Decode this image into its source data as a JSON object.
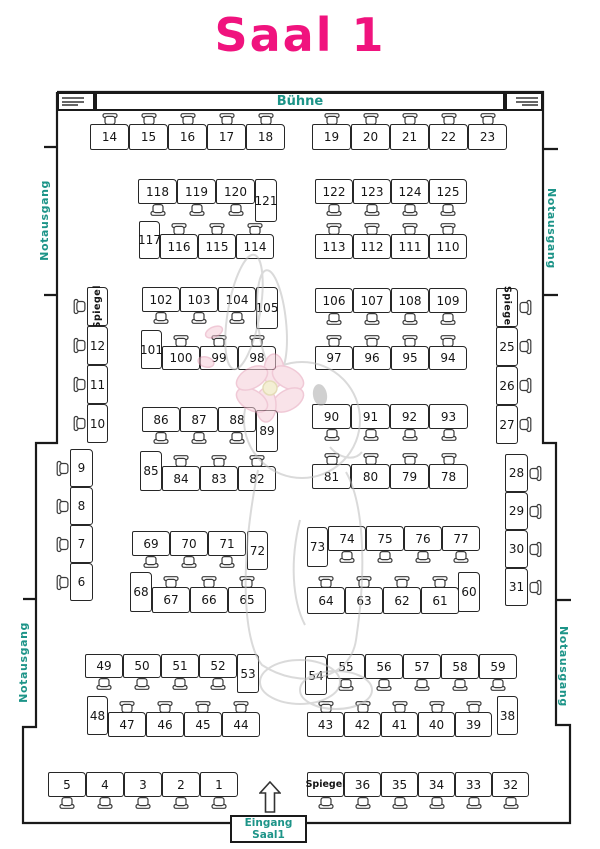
{
  "title": "Saal 1",
  "labels": {
    "stage": "Bühne",
    "exit": "Notausgang",
    "mirror": "Spiegel",
    "entrance_line1": "Eingang",
    "entrance_line2": "Saal1"
  },
  "colors": {
    "pink": "#f0137e",
    "teal": "#1d9488",
    "line": "#1a1a1a"
  },
  "groups": [
    {
      "type": "hrow",
      "x": 90,
      "y": 124,
      "w": 39,
      "h": 26,
      "chair": "top",
      "tables": [
        "14",
        "15",
        "16",
        "17",
        "18"
      ]
    },
    {
      "type": "hrow",
      "x": 312,
      "y": 124,
      "w": 39,
      "h": 26,
      "chair": "top",
      "tables": [
        "19",
        "20",
        "21",
        "22",
        "23"
      ]
    },
    {
      "type": "hrow",
      "x": 138,
      "y": 179,
      "w": 39,
      "h": 25,
      "chair": "bottom",
      "tables": [
        "118",
        "119",
        "120"
      ]
    },
    {
      "type": "vtable",
      "x": 255,
      "y": 179,
      "w": 22,
      "h": 43,
      "label": "121"
    },
    {
      "type": "hrow",
      "x": 315,
      "y": 179,
      "w": 38,
      "h": 25,
      "chair": "bottom",
      "tables": [
        "122",
        "123",
        "124",
        "125"
      ]
    },
    {
      "type": "vtable",
      "x": 139,
      "y": 221,
      "w": 21,
      "h": 38,
      "label": "117"
    },
    {
      "type": "hrow",
      "x": 160,
      "y": 234,
      "w": 38,
      "h": 25,
      "chair": "top",
      "tables": [
        "116",
        "115",
        "114"
      ]
    },
    {
      "type": "hrow",
      "x": 315,
      "y": 234,
      "w": 38,
      "h": 25,
      "chair": "top",
      "tables": [
        "113",
        "112",
        "111",
        "110"
      ]
    },
    {
      "type": "hrow",
      "x": 142,
      "y": 287,
      "w": 38,
      "h": 25,
      "chair": "bottom",
      "tables": [
        "102",
        "103",
        "104"
      ]
    },
    {
      "type": "vtable",
      "x": 256,
      "y": 287,
      "w": 22,
      "h": 42,
      "label": "105"
    },
    {
      "type": "hrow",
      "x": 315,
      "y": 288,
      "w": 38,
      "h": 25,
      "chair": "bottom",
      "tables": [
        "106",
        "107",
        "108",
        "109"
      ]
    },
    {
      "type": "vtable",
      "x": 141,
      "y": 330,
      "w": 21,
      "h": 39,
      "label": "101"
    },
    {
      "type": "hrow",
      "x": 162,
      "y": 346,
      "w": 38,
      "h": 24,
      "chair": "top",
      "tables": [
        "100",
        "99",
        "98"
      ]
    },
    {
      "type": "hrow",
      "x": 315,
      "y": 346,
      "w": 38,
      "h": 24,
      "chair": "top",
      "tables": [
        "97",
        "96",
        "95",
        "94"
      ]
    },
    {
      "type": "hrow",
      "x": 142,
      "y": 407,
      "w": 38,
      "h": 25,
      "chair": "bottom",
      "tables": [
        "86",
        "87",
        "88"
      ]
    },
    {
      "type": "vtable",
      "x": 256,
      "y": 410,
      "w": 22,
      "h": 42,
      "label": "89"
    },
    {
      "type": "hrow",
      "x": 312,
      "y": 404,
      "w": 39,
      "h": 25,
      "chair": "bottom",
      "tables": [
        "90",
        "91",
        "92",
        "93"
      ]
    },
    {
      "type": "vtable",
      "x": 140,
      "y": 451,
      "w": 22,
      "h": 40,
      "label": "85"
    },
    {
      "type": "hrow",
      "x": 162,
      "y": 466,
      "w": 38,
      "h": 25,
      "chair": "top",
      "tables": [
        "84",
        "83",
        "82"
      ]
    },
    {
      "type": "hrow",
      "x": 312,
      "y": 464,
      "w": 39,
      "h": 25,
      "chair": "top",
      "tables": [
        "81",
        "80",
        "79",
        "78"
      ]
    },
    {
      "type": "hrow",
      "x": 132,
      "y": 531,
      "w": 38,
      "h": 25,
      "chair": "bottom",
      "tables": [
        "69",
        "70",
        "71"
      ]
    },
    {
      "type": "vtable",
      "x": 247,
      "y": 531,
      "w": 21,
      "h": 39,
      "label": "72"
    },
    {
      "type": "vtable",
      "x": 307,
      "y": 527,
      "w": 21,
      "h": 40,
      "label": "73"
    },
    {
      "type": "hrow",
      "x": 328,
      "y": 526,
      "w": 38,
      "h": 25,
      "chair": "bottom",
      "tables": [
        "74",
        "75",
        "76",
        "77"
      ]
    },
    {
      "type": "vtable",
      "x": 130,
      "y": 572,
      "w": 22,
      "h": 40,
      "label": "68"
    },
    {
      "type": "hrow",
      "x": 152,
      "y": 587,
      "w": 38,
      "h": 26,
      "chair": "top",
      "tables": [
        "67",
        "66",
        "65"
      ]
    },
    {
      "type": "hrow",
      "x": 307,
      "y": 587,
      "w": 38,
      "h": 27,
      "chair": "top",
      "tables": [
        "64",
        "63",
        "62",
        "61"
      ]
    },
    {
      "type": "vtable",
      "x": 458,
      "y": 572,
      "w": 22,
      "h": 40,
      "label": "60"
    },
    {
      "type": "hrow",
      "x": 85,
      "y": 654,
      "w": 38,
      "h": 24,
      "chair": "bottom",
      "tables": [
        "49",
        "50",
        "51",
        "52"
      ]
    },
    {
      "type": "vtable",
      "x": 237,
      "y": 654,
      "w": 22,
      "h": 39,
      "label": "53"
    },
    {
      "type": "vtable",
      "x": 305,
      "y": 656,
      "w": 22,
      "h": 39,
      "label": "54"
    },
    {
      "type": "hrow",
      "x": 327,
      "y": 654,
      "w": 38,
      "h": 25,
      "chair": "bottom",
      "tables": [
        "55",
        "56",
        "57",
        "58",
        "59"
      ]
    },
    {
      "type": "vtable",
      "x": 87,
      "y": 696,
      "w": 21,
      "h": 39,
      "label": "48"
    },
    {
      "type": "hrow",
      "x": 108,
      "y": 712,
      "w": 38,
      "h": 25,
      "chair": "top",
      "tables": [
        "47",
        "46",
        "45",
        "44"
      ]
    },
    {
      "type": "hrow",
      "x": 307,
      "y": 712,
      "w": 37,
      "h": 25,
      "chair": "top",
      "tables": [
        "43",
        "42",
        "41",
        "40",
        "39"
      ]
    },
    {
      "type": "vtable",
      "x": 497,
      "y": 696,
      "w": 21,
      "h": 39,
      "label": "38"
    },
    {
      "type": "hrow",
      "x": 48,
      "y": 772,
      "w": 38,
      "h": 25,
      "chair": "bottom",
      "tables": [
        "5",
        "4",
        "3",
        "2",
        "1"
      ]
    },
    {
      "type": "hrow",
      "x": 307,
      "y": 772,
      "w": 37,
      "h": 25,
      "chair": "bottom",
      "tables": [
        "Spiegel",
        "36",
        "35",
        "34",
        "33",
        "32"
      ]
    },
    {
      "type": "vcol",
      "x": 87,
      "y": 287,
      "w": 21,
      "h": 39,
      "chair": "left",
      "tables": [
        "Spiegel",
        "12",
        "11",
        "10"
      ]
    },
    {
      "type": "vcol",
      "x": 70,
      "y": 449,
      "w": 23,
      "h": 38,
      "chair": "left",
      "tables": [
        "9",
        "8",
        "7",
        "6"
      ]
    },
    {
      "type": "vcol",
      "x": 496,
      "y": 288,
      "w": 22,
      "h": 39,
      "chair": "right",
      "tables": [
        "Spiegel",
        "25",
        "26",
        "27"
      ]
    },
    {
      "type": "vcol",
      "x": 505,
      "y": 454,
      "w": 23,
      "h": 38,
      "chair": "right",
      "tables": [
        "28",
        "29",
        "30",
        "31"
      ]
    }
  ]
}
